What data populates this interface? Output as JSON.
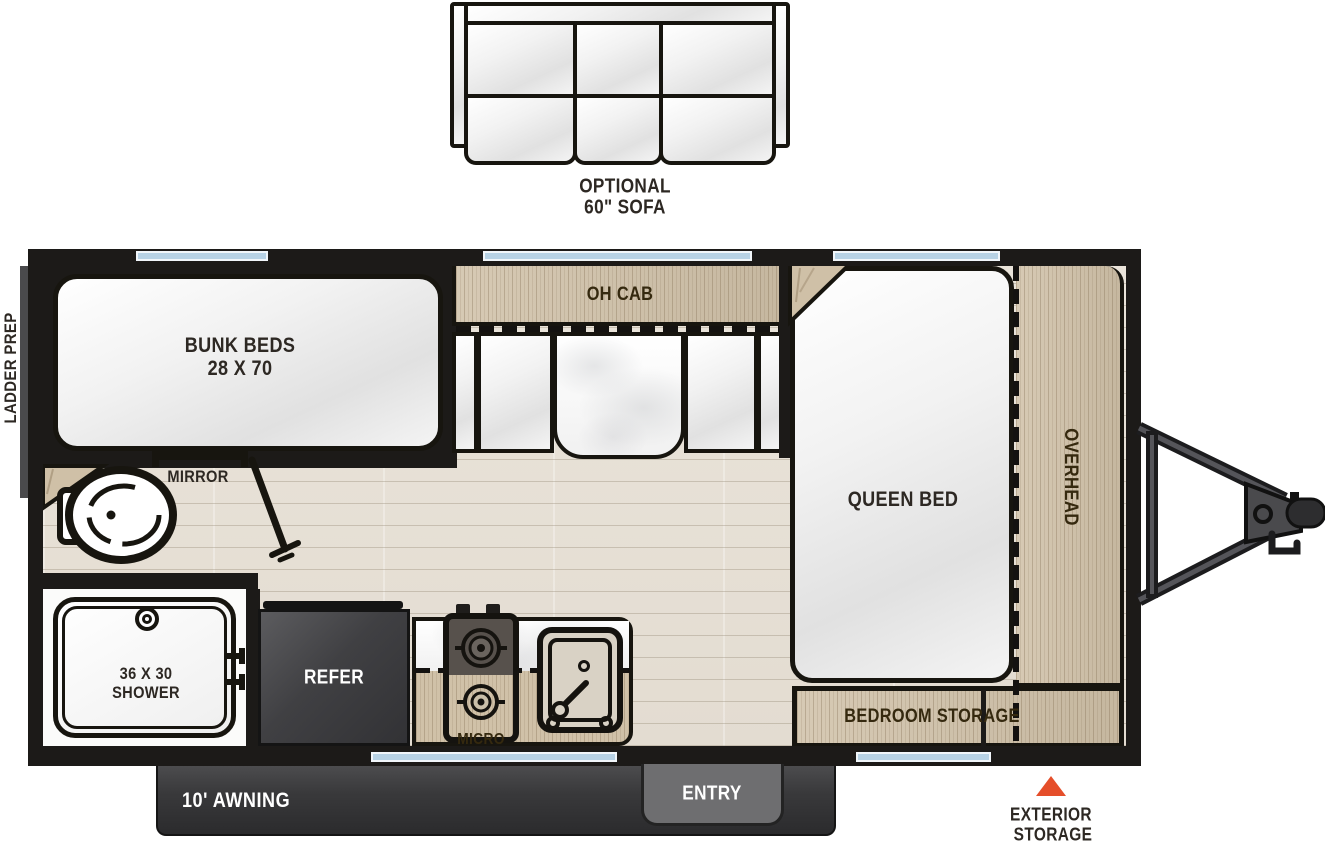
{
  "palette": {
    "wall": "#1c1a18",
    "wood": "#d0c1a8",
    "floor": "#e8e2d7",
    "window_blue": "#b7d2e5",
    "accent_orange": "#e54e2a",
    "refer_gray": "#48484b",
    "awning_gray": "#3a3a3c",
    "entry_gray": "#6e6e70",
    "label_dark": "#2d2823",
    "white": "#ffffff"
  },
  "sofa": {
    "label_line1": "OPTIONAL",
    "label_line2": "60\" SOFA"
  },
  "exterior_labels": {
    "ladder_prep": "LADDER PREP",
    "awning": "10' AWNING",
    "entry": "ENTRY",
    "exterior_storage_line1": "EXTERIOR",
    "exterior_storage_line2": "STORAGE"
  },
  "interior": {
    "bunk_line1": "BUNK BEDS",
    "bunk_line2": "28 X 70",
    "oh_cab": "OH CAB",
    "queen_bed": "QUEEN BED",
    "overhead": "OVERHEAD",
    "bedroom_storage": "BEDROOM STORAGE",
    "mirror": "MIRROR",
    "shower_line1": "36 X 30",
    "shower_line2": "SHOWER",
    "refer": "REFER",
    "micro": "MICRO"
  }
}
